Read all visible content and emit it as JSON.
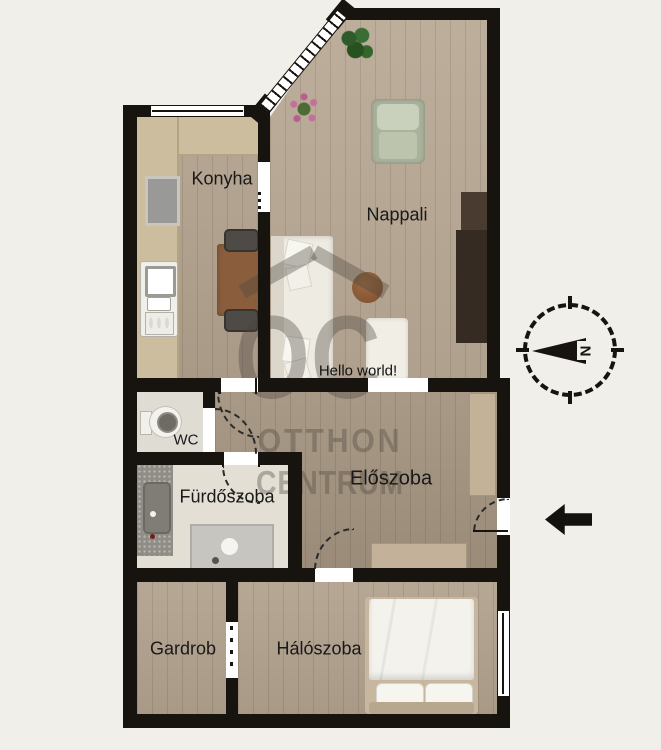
{
  "floorplan": {
    "rooms": [
      {
        "id": "konyha",
        "label": "Konyha"
      },
      {
        "id": "nappali",
        "label": "Nappali"
      },
      {
        "id": "wc",
        "label": "WC"
      },
      {
        "id": "furdoszoba",
        "label": "Fürdőszoba"
      },
      {
        "id": "eloszoba",
        "label": "Előszoba"
      },
      {
        "id": "gardrob",
        "label": "Gardrob"
      },
      {
        "id": "haloszoba",
        "label": "Hálószoba"
      }
    ],
    "hello_text": "Hello world!",
    "watermark": {
      "logo_letters": "OC",
      "line1": "OTTHON",
      "line2": "CENTRUM"
    },
    "compass": {
      "letter": "N"
    },
    "colors": {
      "background": "#f0efea",
      "walls": "#17130e",
      "wood_floor": "#b2a18e",
      "bath_floor": "#e4dfd4",
      "counter_tan": "#cdbd9f",
      "table_brown": "#8a5e3d",
      "tv_cabinet": "#352b23",
      "sofa_white": "#eeebe2",
      "armchair_green": "#b9c1ac"
    }
  }
}
